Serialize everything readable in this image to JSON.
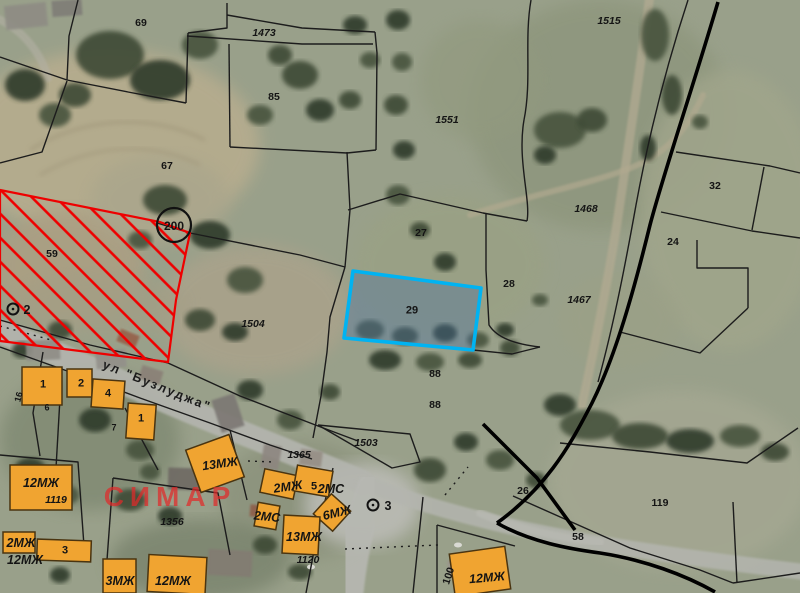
{
  "map": {
    "description": "Cadastral regulation plan overlaid on satellite imagery",
    "colors": {
      "base": "#99a08a",
      "boundary": "#1c1c1c",
      "boundary_thick": "#000000",
      "hatch": "#ee0000",
      "highlight_stroke": "#00b3f2",
      "highlight_fill": "rgba(70,110,160,0.38)",
      "building_fill": "#f0a431",
      "building_stroke": "#4a3410",
      "label": "#141414",
      "watermark": "rgba(225,42,42,0.72)",
      "road": "#b6b7b1"
    },
    "selected_parcel": {
      "number": "29",
      "points": "353,271 481,288 473,350 344,338"
    },
    "restricted_area": {
      "number": "200",
      "points": "0,190 160,222 190,233 176,300 168,362 0,341"
    },
    "survey_circle": {
      "cx": 174,
      "cy": 225,
      "r": 17
    },
    "markers": [
      {
        "cx": 13,
        "cy": 309
      },
      {
        "cx": 373,
        "cy": 505
      }
    ],
    "boundaries": [
      {
        "d": "M78,0 L69,36 L67,80"
      },
      {
        "d": "M0,57 L67,80"
      },
      {
        "d": "M67,80 L128,92 L186,103"
      },
      {
        "d": "M186,103 L188,33"
      },
      {
        "d": "M188,33 L227,28 L227,3"
      },
      {
        "d": "M227,15 L302,28 L375,32"
      },
      {
        "d": "M187,36 L302,44 L373,44"
      },
      {
        "d": "M375,32 L377,53 L376,150"
      },
      {
        "d": "M229,44 L230,147"
      },
      {
        "d": "M230,147 L347,153 L376,150"
      },
      {
        "d": "M0,163 L42,152 L67,81"
      },
      {
        "d": "M157,223 L190,233 L300,255 L345,267"
      },
      {
        "d": "M347,152 L350,210 L345,267"
      },
      {
        "d": "M348,210 L400,194 L483,213 L527,221"
      },
      {
        "d": "M531,0 C524,40 532,80 524,120 C517,160 531,200 527,221"
      },
      {
        "d": "M486,214 L486,270 L489,325 C497,338 515,344 540,347"
      },
      {
        "d": "M345,267 L330,317 L327,352 L321,396 L313,438"
      },
      {
        "d": "M473,350 L512,354 L540,347"
      },
      {
        "d": "M168,363 L240,396 L318,426 L358,441"
      },
      {
        "d": "M318,425 L410,434 L420,462 L392,468 L318,425"
      },
      {
        "d": "M688,0 C665,70 648,140 636,205 C627,255 615,320 598,382"
      },
      {
        "d": "M661,212 L752,231 L800,238"
      },
      {
        "d": "M676,152 L770,166 L800,173"
      },
      {
        "d": "M764,167 L752,230"
      },
      {
        "d": "M697,240 L697,268 L748,268 L748,308"
      },
      {
        "d": "M620,332 L700,353 L748,308"
      },
      {
        "d": "M560,443 L650,452 L747,463 L798,428"
      },
      {
        "d": "M513,496 L630,548 L700,570 L733,583"
      },
      {
        "d": "M733,502 L737,583"
      },
      {
        "d": "M733,583 L800,573"
      },
      {
        "d": "M0,320 L90,345 L168,363"
      },
      {
        "d": "M0,347 L70,372 L140,398 L210,423 L270,445 L312,459"
      },
      {
        "d": "M43,352 L33,413 L40,456"
      },
      {
        "d": "M60,398 L56,468"
      },
      {
        "d": "M0,455 L78,462 L85,560"
      },
      {
        "d": "M113,478 L218,493 L230,555"
      },
      {
        "d": "M113,478 L107,560"
      },
      {
        "d": "M333,468 L318,530 L306,593"
      },
      {
        "d": "M423,497 L413,593"
      },
      {
        "d": "M437,525 L437,593"
      },
      {
        "d": "M437,525 L515,546"
      },
      {
        "d": "M230,430 L247,500"
      },
      {
        "d": "M125,408 L158,470"
      },
      {
        "d": "M718,2 C692,90 663,175 650,225 C634,290 616,355 592,403 C578,430 568,448 553,468 C535,492 515,510 497,523",
        "w": 3.6
      },
      {
        "d": "M497,523 C530,542 570,549 600,553 C645,560 685,575 715,592",
        "w": 3.6
      },
      {
        "d": "M483,424 L537,478 L575,530",
        "w": 3.6
      },
      {
        "d": "M0,326 L55,341",
        "dash": 1
      },
      {
        "d": "M345,549 L438,545",
        "dash": 1
      },
      {
        "d": "M248,461 L274,462",
        "dash": 1
      },
      {
        "d": "M445,495 L468,467",
        "dash": 1
      }
    ],
    "buildings": [
      {
        "x": 22,
        "y": 367,
        "w": 40,
        "h": 38,
        "rot": 0
      },
      {
        "x": 67,
        "y": 369,
        "w": 25,
        "h": 28,
        "rot": 0
      },
      {
        "x": 92,
        "y": 380,
        "w": 32,
        "h": 28,
        "rot": 4
      },
      {
        "x": 127,
        "y": 404,
        "w": 28,
        "h": 35,
        "rot": 4
      },
      {
        "x": 10,
        "y": 465,
        "w": 62,
        "h": 45,
        "rot": 0
      },
      {
        "x": 192,
        "y": 441,
        "w": 46,
        "h": 45,
        "rot": -20
      },
      {
        "x": 3,
        "y": 532,
        "w": 32,
        "h": 21,
        "rot": 0
      },
      {
        "x": 37,
        "y": 540,
        "w": 54,
        "h": 21,
        "rot": 2
      },
      {
        "x": 103,
        "y": 559,
        "w": 33,
        "h": 34,
        "rot": 0
      },
      {
        "x": 148,
        "y": 556,
        "w": 58,
        "h": 37,
        "rot": 3
      },
      {
        "x": 262,
        "y": 472,
        "w": 34,
        "h": 24,
        "rot": 12
      },
      {
        "x": 295,
        "y": 468,
        "w": 36,
        "h": 26,
        "rot": 10
      },
      {
        "x": 319,
        "y": 499,
        "w": 26,
        "h": 27,
        "rot": 42
      },
      {
        "x": 283,
        "y": 516,
        "w": 36,
        "h": 38,
        "rot": 3
      },
      {
        "x": 256,
        "y": 504,
        "w": 22,
        "h": 24,
        "rot": 10
      },
      {
        "x": 452,
        "y": 550,
        "w": 56,
        "h": 43,
        "rot": -8
      }
    ],
    "labels": [
      {
        "t": "69",
        "x": 141,
        "y": 23,
        "k": "parcel"
      },
      {
        "t": "1473",
        "x": 264,
        "y": 33,
        "k": "parcel",
        "i": 1
      },
      {
        "t": "85",
        "x": 274,
        "y": 97,
        "k": "parcel"
      },
      {
        "t": "1515",
        "x": 609,
        "y": 21,
        "k": "parcel",
        "i": 1
      },
      {
        "t": "67",
        "x": 167,
        "y": 166,
        "k": "parcel"
      },
      {
        "t": "1551",
        "x": 447,
        "y": 120,
        "k": "parcel",
        "i": 1
      },
      {
        "t": "59",
        "x": 52,
        "y": 254,
        "k": "parcel"
      },
      {
        "t": "200",
        "x": 174,
        "y": 226,
        "k": "parcel",
        "s": 12
      },
      {
        "t": "32",
        "x": 715,
        "y": 186,
        "k": "parcel"
      },
      {
        "t": "1468",
        "x": 586,
        "y": 209,
        "k": "parcel",
        "i": 1
      },
      {
        "t": "27",
        "x": 421,
        "y": 233,
        "k": "parcel"
      },
      {
        "t": "24",
        "x": 673,
        "y": 242,
        "k": "parcel"
      },
      {
        "t": "28",
        "x": 509,
        "y": 284,
        "k": "parcel"
      },
      {
        "t": "1467",
        "x": 579,
        "y": 300,
        "k": "parcel",
        "i": 1
      },
      {
        "t": "29",
        "x": 412,
        "y": 311,
        "k": "parcel",
        "s": 11
      },
      {
        "t": "1504",
        "x": 253,
        "y": 324,
        "k": "parcel",
        "i": 1
      },
      {
        "t": "88",
        "x": 435,
        "y": 374,
        "k": "parcel"
      },
      {
        "t": "88",
        "x": 435,
        "y": 405,
        "k": "parcel"
      },
      {
        "t": "1503",
        "x": 366,
        "y": 443,
        "k": "parcel",
        "i": 1
      },
      {
        "t": "1365",
        "x": 299,
        "y": 455,
        "k": "parcel",
        "i": 1
      },
      {
        "t": "26",
        "x": 523,
        "y": 491,
        "k": "parcel"
      },
      {
        "t": "119",
        "x": 660,
        "y": 503,
        "k": "parcel"
      },
      {
        "t": "58",
        "x": 578,
        "y": 537,
        "k": "parcel"
      },
      {
        "t": "1356",
        "x": 172,
        "y": 522,
        "k": "parcel",
        "i": 1
      },
      {
        "t": "1119",
        "x": 56,
        "y": 500,
        "k": "parcel",
        "i": 1
      },
      {
        "t": "1120",
        "x": 308,
        "y": 560,
        "k": "parcel",
        "i": 1
      },
      {
        "t": "100",
        "x": 449,
        "y": 576,
        "k": "parcel",
        "rot": -72
      },
      {
        "t": "2",
        "x": 27,
        "y": 310,
        "k": "marker"
      },
      {
        "t": "3",
        "x": 388,
        "y": 506,
        "k": "marker"
      },
      {
        "t": "12МЖ",
        "x": 41,
        "y": 483,
        "k": "bcode"
      },
      {
        "t": "13МЖ",
        "x": 220,
        "y": 464,
        "k": "bcode",
        "rot": -8
      },
      {
        "t": "2МЖ",
        "x": 288,
        "y": 487,
        "k": "bcode",
        "rot": -8
      },
      {
        "t": "5",
        "x": 314,
        "y": 487,
        "k": "bnum"
      },
      {
        "t": "2МС",
        "x": 331,
        "y": 489,
        "k": "bcode"
      },
      {
        "t": "6МЖ",
        "x": 337,
        "y": 513,
        "k": "bcode",
        "rot": -14
      },
      {
        "t": "2МС",
        "x": 267,
        "y": 517,
        "k": "bcode",
        "rot": 6
      },
      {
        "t": "13МЖ",
        "x": 304,
        "y": 537,
        "k": "bcode"
      },
      {
        "t": "12МЖ",
        "x": 487,
        "y": 578,
        "k": "bcode",
        "rot": -5
      },
      {
        "t": "3МЖ",
        "x": 120,
        "y": 581,
        "k": "bcode"
      },
      {
        "t": "12МЖ",
        "x": 173,
        "y": 581,
        "k": "bcode"
      },
      {
        "t": "2МЖ",
        "x": 21,
        "y": 543,
        "k": "bcode"
      },
      {
        "t": "12МЖ",
        "x": 25,
        "y": 560,
        "k": "bcode"
      },
      {
        "t": "1",
        "x": 43,
        "y": 385,
        "k": "bnum"
      },
      {
        "t": "2",
        "x": 81,
        "y": 384,
        "k": "bnum"
      },
      {
        "t": "4",
        "x": 108,
        "y": 394,
        "k": "bnum"
      },
      {
        "t": "1",
        "x": 141,
        "y": 419,
        "k": "bnum"
      },
      {
        "t": "3",
        "x": 65,
        "y": 551,
        "k": "bnum"
      },
      {
        "t": "6",
        "x": 47,
        "y": 408,
        "k": "small"
      },
      {
        "t": "7",
        "x": 114,
        "y": 428,
        "k": "small"
      },
      {
        "t": "16",
        "x": 19,
        "y": 397,
        "k": "small",
        "rot": -75
      },
      {
        "t": "ул \"Бузлуджа\"",
        "x": 157,
        "y": 386,
        "k": "street",
        "rot": 22
      },
      {
        "t": "СИМАР",
        "x": 170,
        "y": 497,
        "k": "watermark"
      }
    ]
  }
}
